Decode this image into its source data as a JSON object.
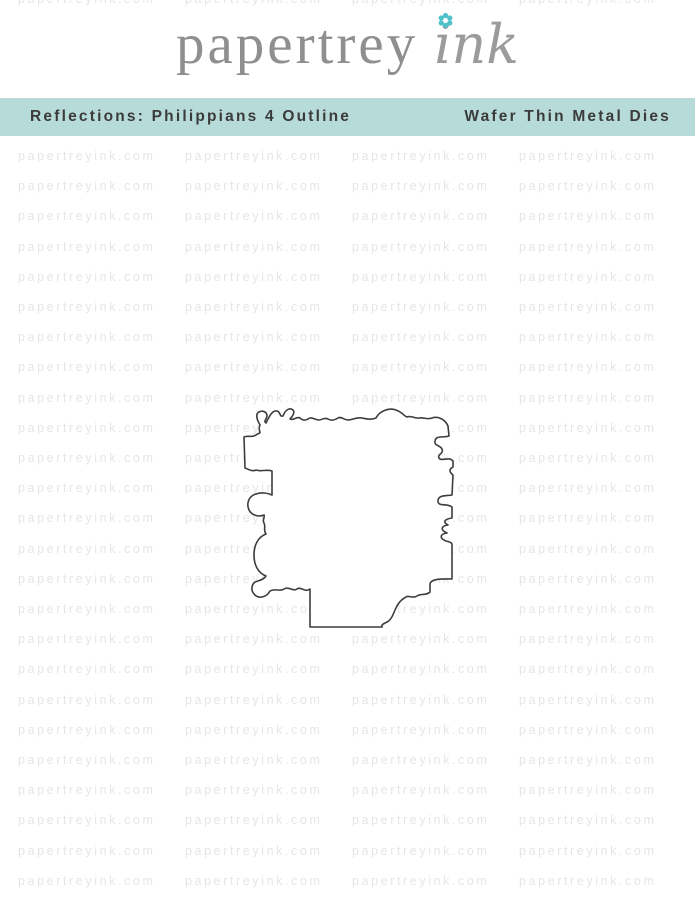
{
  "logo": {
    "brand_serif": "papertrey",
    "brand_script": "ink",
    "flower_icon": "flower-icon"
  },
  "banner": {
    "left_label": "Reflections: Philippians 4 Outline",
    "right_label": "Wafer Thin Metal Dies"
  },
  "watermark": {
    "text": "papertreyink.com",
    "rows": 25,
    "cols": 4,
    "partial_top_row": true
  },
  "colors": {
    "banner_bg": "#b7dbd9",
    "banner_text": "#3b3b3b",
    "logo_gray": "#8f8f8f",
    "logo_gray2": "#9b9b9b",
    "flower_teal": "#4ec1ca",
    "watermark_gray": "#e6e6e6",
    "die_stroke": "#3d3d3d"
  }
}
